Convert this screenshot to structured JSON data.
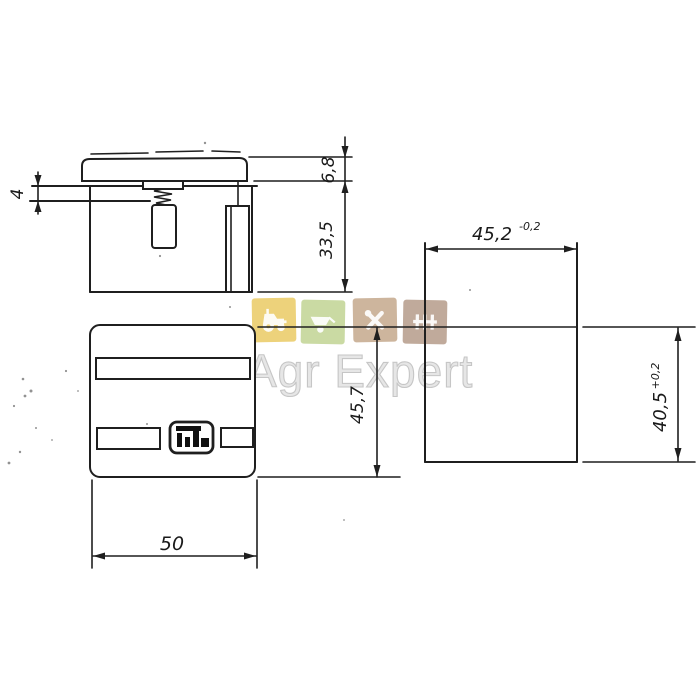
{
  "views": {
    "side": {
      "dim_cap_height": "6,8",
      "dim_body_height": "33,5",
      "dim_terminal": "4"
    },
    "front": {
      "dim_width": "50",
      "dim_height": "45,7"
    },
    "cutout": {
      "dim_width": "45,2",
      "dim_width_tol": "-0,2",
      "dim_height": "40,5",
      "dim_height_tol": "+0,2"
    }
  },
  "watermark": {
    "text": "Agr Expert",
    "icons": [
      {
        "name": "tractor-icon",
        "background": "#edd27b"
      },
      {
        "name": "wheelbarrow-icon",
        "background": "#cadaa3"
      },
      {
        "name": "tools-icon",
        "background": "#cdb59d"
      },
      {
        "name": "harrow-icon",
        "background": "#c0aa9b"
      }
    ]
  },
  "colors": {
    "line": "#1f1f1f",
    "background": "#ffffff",
    "watermark_text": "#c6c6c6"
  }
}
